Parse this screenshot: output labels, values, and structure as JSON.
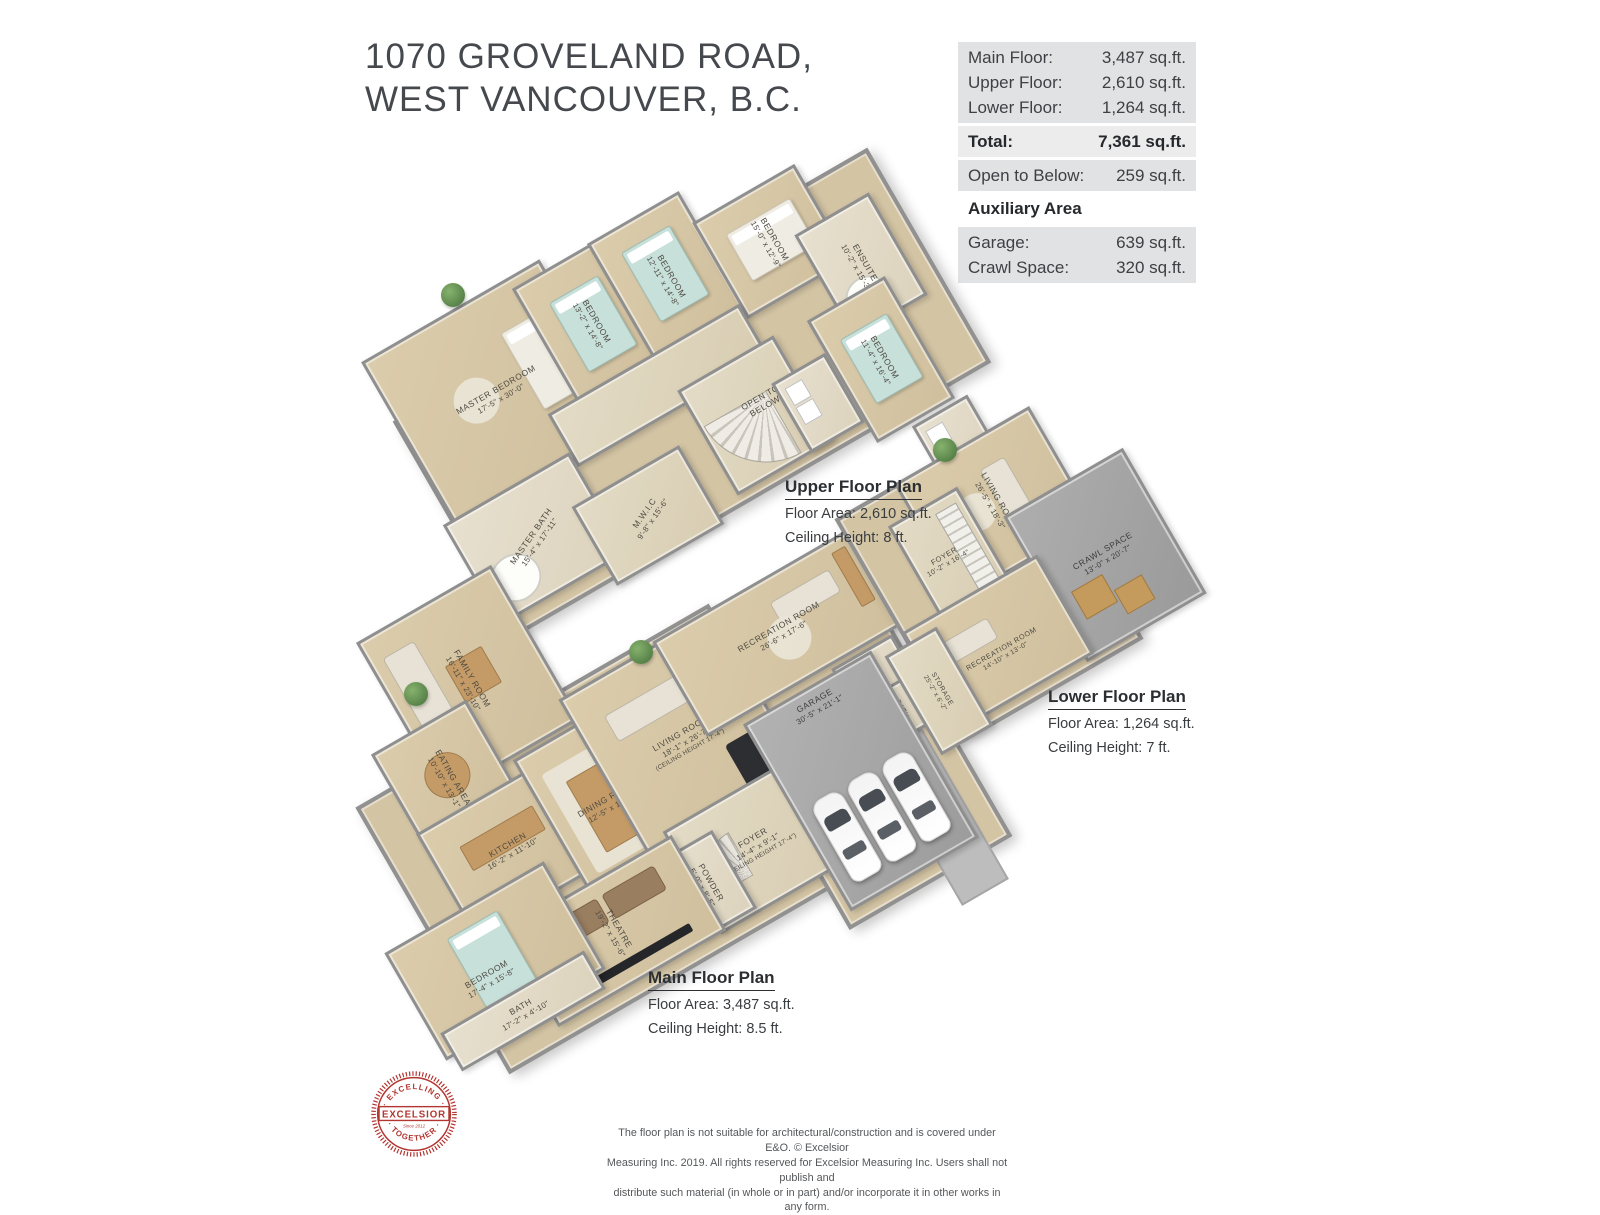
{
  "title": {
    "line1": "1070 GROVELAND ROAD,",
    "line2": "WEST VANCOUVER, B.C."
  },
  "area_table": {
    "floors": [
      {
        "label": "Main Floor:",
        "value": "3,487 sq.ft."
      },
      {
        "label": "Upper Floor:",
        "value": "2,610 sq.ft."
      },
      {
        "label": "Lower Floor:",
        "value": "1,264 sq.ft."
      }
    ],
    "total": {
      "label": "Total:",
      "value": "7,361 sq.ft."
    },
    "open_below": {
      "label": "Open to Below:",
      "value": "259 sq.ft."
    },
    "auxiliary_heading": "Auxiliary Area",
    "auxiliary": [
      {
        "label": "Garage:",
        "value": "639 sq.ft."
      },
      {
        "label": "Crawl Space:",
        "value": "320 sq.ft."
      }
    ]
  },
  "plans": {
    "upper": {
      "caption": "Upper Floor Plan",
      "area_line": "Floor Area: 2,610 sq.ft.",
      "ceiling_line": "Ceiling Height: 8 ft.",
      "rooms": {
        "master_bedroom": {
          "name": "MASTER BEDROOM",
          "dims": "17'-5\" x 30'-0\""
        },
        "bedroom_1": {
          "name": "BEDROOM",
          "dims": "13'-2\" x 14'-8\""
        },
        "bedroom_2": {
          "name": "BEDROOM",
          "dims": "12'-11\" x 14'-8\""
        },
        "bedroom_3": {
          "name": "BEDROOM",
          "dims": "15'-0\" x 12'-9\""
        },
        "ensuite": {
          "name": "ENSUITE",
          "dims": "10'-2\" x 15'-3\""
        },
        "bedroom_4": {
          "name": "BEDROOM",
          "dims": "11'-4\" x 16'-4\""
        },
        "open_below": {
          "name": "OPEN TO BELOW"
        },
        "master_bath": {
          "name": "MASTER BATH",
          "dims": "15'-4\" x 17'-11\""
        },
        "mwic": {
          "name": "M.W.I.C",
          "dims": "9'-8\" x 15'-6\""
        }
      }
    },
    "main": {
      "caption": "Main Floor Plan",
      "area_line": "Floor Area: 3,487 sq.ft.",
      "ceiling_line": "Ceiling Height: 8.5 ft.",
      "rooms": {
        "family_room": {
          "name": "FAMILY ROOM",
          "dims": "16'-11\" x 23'-10\""
        },
        "eating_area": {
          "name": "EATING AREA",
          "dims": "10'-10\" x 13'-1\""
        },
        "kitchen": {
          "name": "KITCHEN",
          "dims": "16'-2\" x 11'-10\""
        },
        "dining_room": {
          "name": "DINING ROOM",
          "dims": "12'-5\" x 19'-7\""
        },
        "living_room": {
          "name": "LIVING ROOM",
          "dims": "18'-1\" x 26'-7\"",
          "note": "(CEILING HEIGHT 17'-4\")"
        },
        "foyer": {
          "name": "FOYER",
          "dims": "14'-4\" x 9'-1\"",
          "note": "(CEILING HEIGHT 17'-4\")"
        },
        "powder": {
          "name": "POWDER",
          "dims": "5'-0\" x 8'-5\""
        },
        "theatre": {
          "name": "THEATRE",
          "dims": "19'-2\" x 15'-6\""
        },
        "bedroom": {
          "name": "BEDROOM",
          "dims": "17'-4\" x 15'-8\""
        },
        "bath": {
          "name": "BATH",
          "dims": "17'-2\" x 4'-10\""
        },
        "recreation_room": {
          "name": "RECREATION ROOM",
          "dims": "26'-6\" x 17'-6\""
        },
        "sauna": {
          "name": "SAUNA",
          "dims": "7'-8\" x 6'-6\""
        },
        "bath_2": {
          "name": "BATH",
          "dims": "7'-10\" x 6'-6\""
        },
        "garage": {
          "name": "GARAGE",
          "dims": "30'-5\" x 21'-1\""
        }
      }
    },
    "lower": {
      "caption": "Lower Floor Plan",
      "area_line": "Floor Area: 1,264 sq.ft.",
      "ceiling_line": "Ceiling Height: 7 ft.",
      "rooms": {
        "foyer": {
          "name": "FOYER",
          "dims": "10'-2\" x 16'-4\""
        },
        "living_room": {
          "name": "LIVING ROOM",
          "dims": "26'-5\" x 18'-3\""
        },
        "storage_1": {
          "name": "STORAGE",
          "dims": "20'-7\" x 8'-10\""
        },
        "crawl_space": {
          "name": "CRAWL SPACE",
          "dims": "13'-0\" x 20'-7\""
        },
        "recreation_room": {
          "name": "RECREATION ROOM",
          "dims": "14'-10\" x 13'-0\""
        },
        "storage_2": {
          "name": "STORAGE",
          "dims": "25'-2\" x 6'-2\""
        }
      }
    }
  },
  "logo": {
    "arc_top": "· EXCELLING ·",
    "banner": "EXCELSIOR",
    "arc_bottom": "· TOGETHER ·",
    "tagline": "Since 2012"
  },
  "disclaimer": {
    "line1": "The floor plan is not suitable for architectural/construction and is covered under E&O. © Excelsior",
    "line2": "Measuring Inc. 2019. All rights reserved for Excelsior Measuring Inc. Users shall not publish and",
    "line3": "distribute such material (in whole or in part) and/or incorporate it in other works in any form."
  },
  "colors": {
    "floor_beige": "#d5c5a5",
    "wall_gray": "#8f8f8f",
    "table_row_bg": "#e1e2e3",
    "logo_red": "#b23530",
    "crawl_floor": "#a2a2a2",
    "bed_teal": "#c8e0da"
  }
}
